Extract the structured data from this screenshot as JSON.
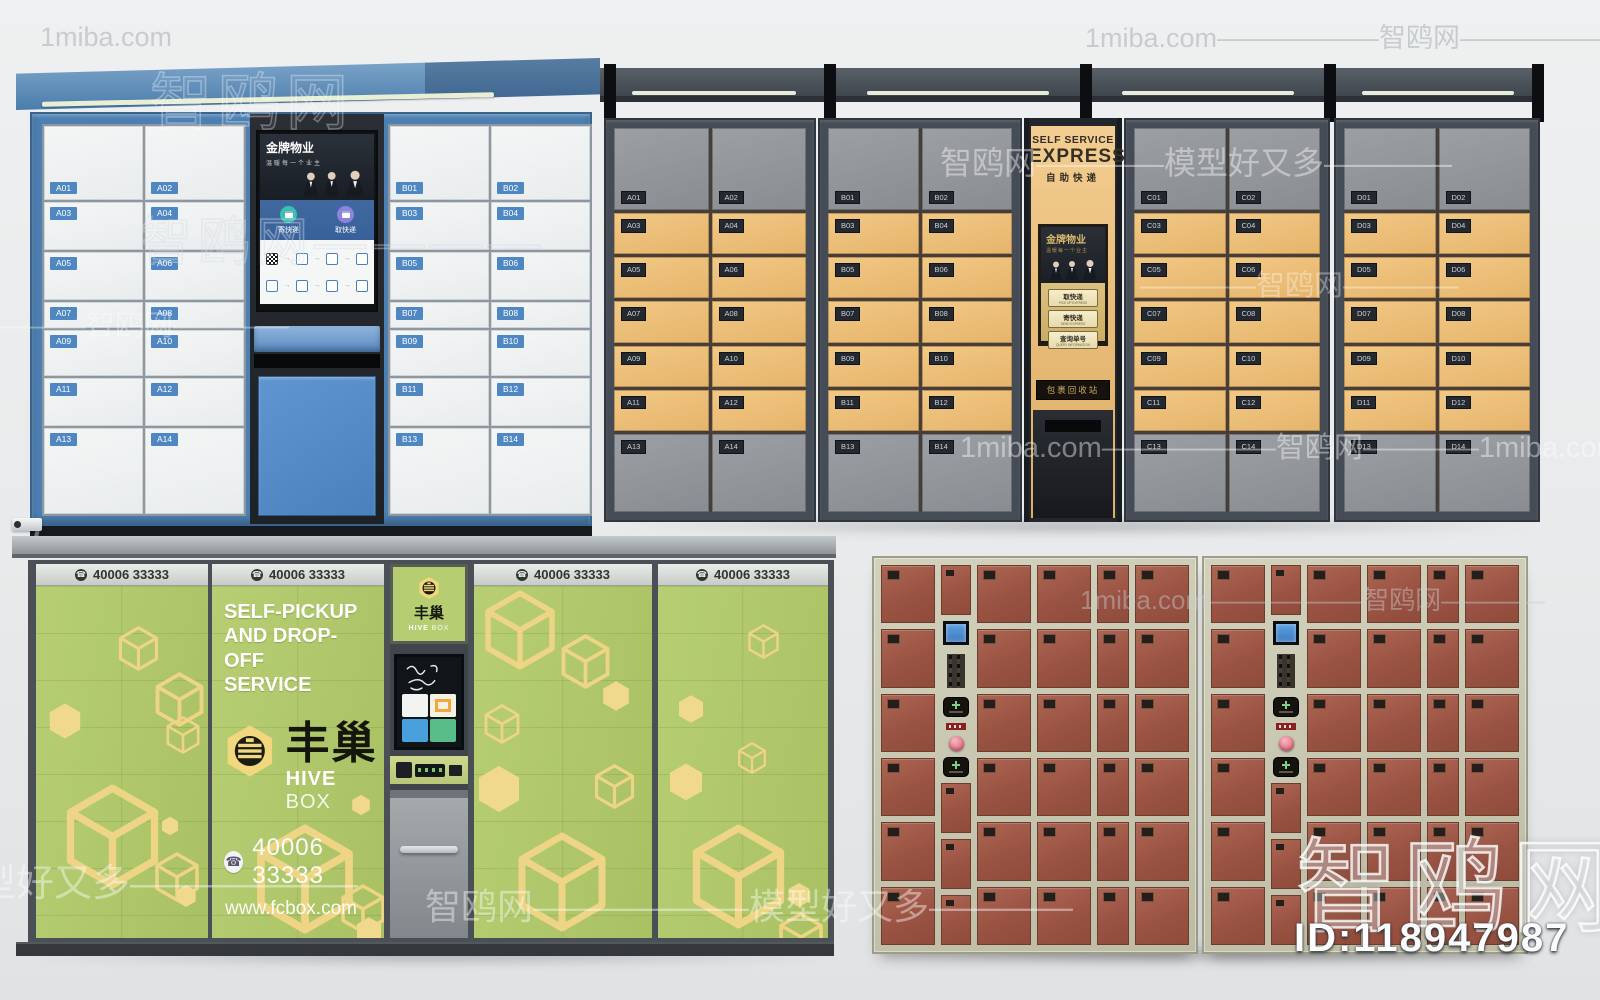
{
  "watermarks": {
    "site_en": "1miba.com",
    "site_cn": "智鸥网",
    "tagline": "模型好又多",
    "id_text": "ID:118947987",
    "dashes_long": "——————",
    "dashes_short": "————"
  },
  "unit_blue": {
    "screen": {
      "title": "金牌物业",
      "subtitle": "温暖每一个业主",
      "send_label": "寄快递",
      "pickup_label": "取快递"
    },
    "left_labels": [
      "A01",
      "A02",
      "A03",
      "A04",
      "A05",
      "A06",
      "A07",
      "A08",
      "A09",
      "A10",
      "A11",
      "A12",
      "A13",
      "A14"
    ],
    "right_labels": [
      "B01",
      "B02",
      "B03",
      "B04",
      "B05",
      "B06",
      "B07",
      "B08",
      "B09",
      "B10",
      "B11",
      "B12",
      "B13",
      "B14"
    ]
  },
  "unit_express": {
    "sign": {
      "line1": "SELF SERVICE",
      "line2": "EXPRESS",
      "line3": "自助快递"
    },
    "screen": {
      "title": "金牌物业",
      "subtitle": "温暖每一个业主",
      "buttons": [
        {
          "cn": "取快递",
          "en": "PICK UP EXPRESS"
        },
        {
          "cn": "寄快递",
          "en": "SEND EXPRESS"
        },
        {
          "cn": "查询单号",
          "en": "QUERY INFORMATION"
        }
      ]
    },
    "recycle_label": "包裹回收站",
    "sections": [
      {
        "name": "A",
        "labels": [
          "A01",
          "A02",
          "A03",
          "A04",
          "A05",
          "A06",
          "A07",
          "A08",
          "A09",
          "A10",
          "A11",
          "A12",
          "A13",
          "A14"
        ]
      },
      {
        "name": "B",
        "labels": [
          "B01",
          "B02",
          "B03",
          "B04",
          "B05",
          "B06",
          "B07",
          "B08",
          "B09",
          "B10",
          "B11",
          "B12",
          "B13",
          "B14"
        ]
      },
      {
        "name": "C",
        "labels": [
          "C01",
          "C02",
          "C03",
          "C04",
          "C05",
          "C06",
          "C07",
          "C08",
          "C09",
          "C10",
          "C11",
          "C12",
          "C13",
          "C14"
        ]
      },
      {
        "name": "D",
        "labels": [
          "D01",
          "D02",
          "D03",
          "D04",
          "D05",
          "D06",
          "D07",
          "D08",
          "D09",
          "D10",
          "D11",
          "D12",
          "D13",
          "D14"
        ]
      }
    ]
  },
  "unit_hive": {
    "header_phone": "40006 33333",
    "service_lines": [
      "SELF-PICKUP",
      "AND DROP-OFF",
      "SERVICE"
    ],
    "brand_cn": "丰巢",
    "brand_en_bold": "HIVE",
    "brand_en_light": "BOX",
    "phone": "40006 33333",
    "website": "www.fcbox.com"
  },
  "unit_red": {
    "doors_per_cabinet": 30,
    "control_extra_doors": 3
  }
}
